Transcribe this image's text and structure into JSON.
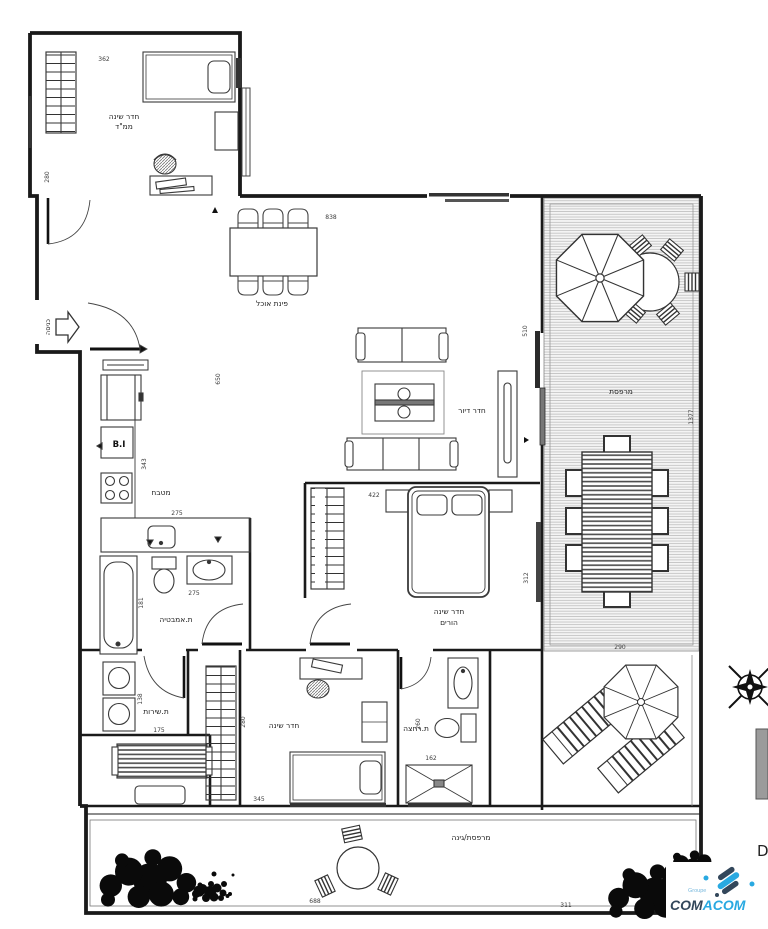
{
  "title": "Apartment floor plan",
  "rooms": {
    "mamad": {
      "line1": "חדר שינה",
      "line2": "ממ\"ד"
    },
    "dining": {
      "label": "פינת אוכל"
    },
    "living": {
      "label": "חדר דיור"
    },
    "kitchen": {
      "label": "מטבח"
    },
    "bathroom": {
      "label": "ת.אמבטיה"
    },
    "service": {
      "label": "ת.שירות"
    },
    "bedroom2": {
      "label": "חדר שינה"
    },
    "shower": {
      "label": "ת.רחצה"
    },
    "master": {
      "line1": "חדר שינה",
      "line2": "הורים"
    },
    "terrace": {
      "label": "מרפסת"
    },
    "garden": {
      "label": "מרפסת/גינה"
    }
  },
  "annotations": {
    "entrance": "כניסה",
    "built_in": "B.I",
    "plan_letter": "D"
  },
  "dimensions": {
    "mamad_width": "362",
    "mamad_height": "280",
    "top_wall": "838",
    "living_height": "650",
    "slider": "510",
    "kitchen_height": "343",
    "kitchen_counter": "275",
    "bath_height": "181",
    "bath_width": "275",
    "service_width": "175",
    "service_height": "138",
    "bedroom2_width": "345",
    "bedroom2_height": "280",
    "shower_width": "162",
    "shower_height": "260",
    "master_width": "422",
    "master_height": "312",
    "terrace_height": "1377",
    "terrace_width": "290",
    "garden_width": "688",
    "garden_right": "311"
  },
  "logo": {
    "groupe": "Groupe",
    "part1": "COM",
    "part2": "ACOM"
  },
  "colors": {
    "wall": "#1a1a1a",
    "furniture_line": "#3a3a3a",
    "deck_line": "#b7b7b7",
    "deck_bg": "#f4f4f4",
    "logo_dark": "#33475b",
    "logo_blue": "#29a9e1",
    "gray_block": "#9b9b9b"
  }
}
